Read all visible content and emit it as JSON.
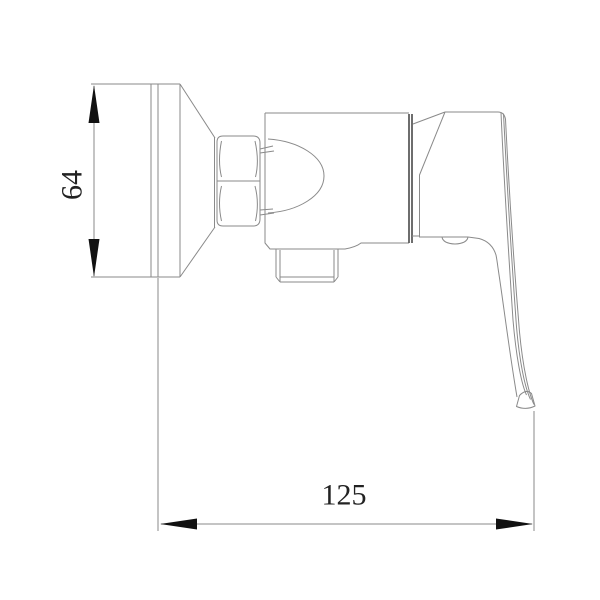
{
  "drawing": {
    "type": "technical-line-drawing",
    "subject": "wall-mounted single-lever shower mixer valve, side elevation view",
    "colors": {
      "background": "#ffffff",
      "outline": "#8a8a8a",
      "seam": "#555555",
      "dimension_line": "#8a8a8a",
      "arrow": "#111111",
      "text": "#222222"
    },
    "dimensions": {
      "height": {
        "label": "64",
        "orientation": "vertical"
      },
      "depth": {
        "label": "125",
        "orientation": "horizontal"
      }
    }
  }
}
